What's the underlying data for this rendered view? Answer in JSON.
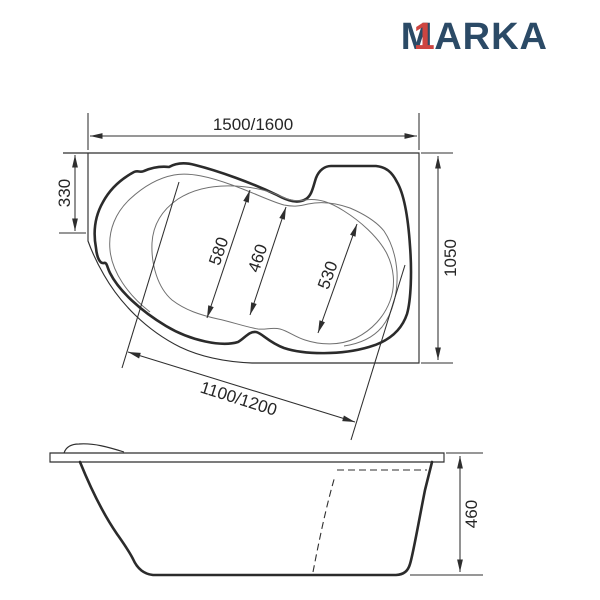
{
  "page": {
    "background": "#ffffff"
  },
  "logo": {
    "m": "M",
    "one": "1",
    "rest": "ARKA",
    "navy_color": "#2b4a66",
    "red_color": "#ce4541"
  },
  "top_view": {
    "overall_width": "1500/1600",
    "overall_depth": "1050",
    "left_offset": "330",
    "front_width": "1100/1200",
    "inner_left": "580",
    "inner_middle": "460",
    "inner_right": "530"
  },
  "side_view": {
    "height": "460"
  }
}
